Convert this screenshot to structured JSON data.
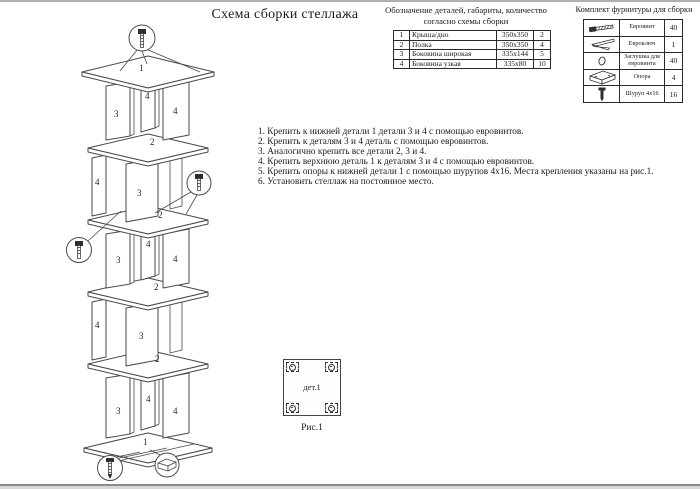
{
  "page": {
    "title": "Схема сборки стеллажа"
  },
  "parts_table": {
    "title_line1": "Обозначение деталей, габариты, количество",
    "title_line2": "согласно схемы сборки",
    "rows": [
      {
        "num": "1",
        "name": "Крыша/дно",
        "size": "350х350",
        "qty": "2"
      },
      {
        "num": "2",
        "name": "Полка",
        "size": "350х350",
        "qty": "4"
      },
      {
        "num": "3",
        "name": "Боковина широкая",
        "size": "335х144",
        "qty": "5"
      },
      {
        "num": "4",
        "name": "Боковина узкая",
        "size": "335х80",
        "qty": "10"
      }
    ]
  },
  "hardware_table": {
    "title": "Комплект фурнитуры для сборки",
    "rows": [
      {
        "icon": "euroscrew-icon",
        "name": "Евровинт",
        "qty": "40"
      },
      {
        "icon": "hexkey-icon",
        "name": "Евроключ",
        "qty": "1"
      },
      {
        "icon": "plug-icon",
        "name": "Заглушка для евровинта",
        "qty": "40"
      },
      {
        "icon": "support-icon",
        "name": "Опора",
        "qty": "4"
      },
      {
        "icon": "screw-icon",
        "name": "Шуруп 4х16",
        "qty": "16"
      }
    ]
  },
  "instructions": [
    "1. Крепить к нижней детали 1 детали 3 и 4 с помощью евровинтов.",
    "2. Крепить к деталям 3 и 4 деталь с помощью евровинтов.",
    "3. Аналогично крепить все детали 2, 3 и 4.",
    "4. Крепить верхнюю деталь 1 к деталям 3 и 4 с помощью евровинтов.",
    "5. Крепить опоры к нижней детали 1 с помощью шурупов 4х16. Места крепления указаны на рис.1.",
    "6. Установить стеллаж на постоянное место."
  ],
  "diagram": {
    "parts": {
      "cap": "1",
      "shelf": "2",
      "side_wide": "3",
      "side_narrow": "4"
    }
  },
  "figure1": {
    "part_label": "дет.1",
    "caption": "Рис.1"
  },
  "colors": {
    "line": "#4a4a4a",
    "text": "#1a1a1a"
  }
}
